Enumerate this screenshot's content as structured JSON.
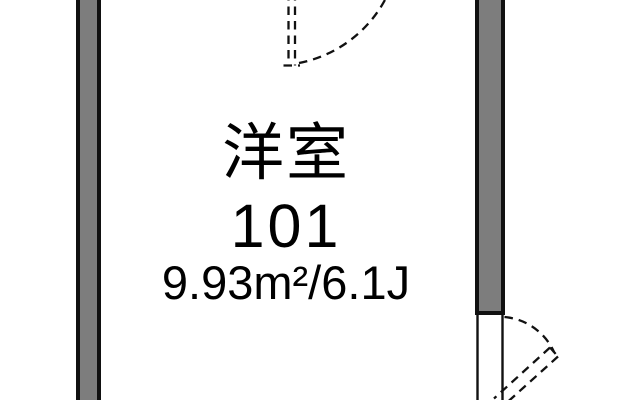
{
  "room": {
    "type_label": "洋室",
    "number": "101",
    "area_label": "9.93m²/6.1J"
  },
  "colors": {
    "wall_fill": "#7d7d7d",
    "outline": "#111111",
    "background": "#ffffff",
    "text": "#000000"
  }
}
